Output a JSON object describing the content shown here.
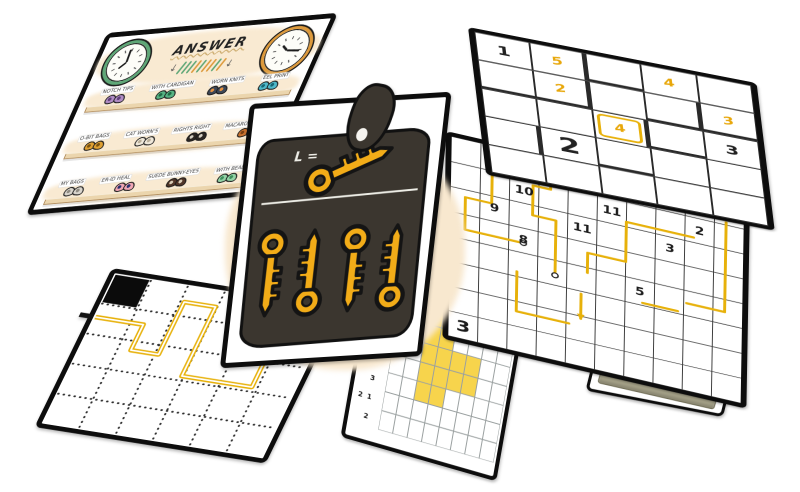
{
  "canvas": {
    "width": 800,
    "height": 492,
    "background": "#FFFFFF"
  },
  "colors": {
    "card_border": "#0D0D0D",
    "gold": "#F2AC18",
    "path_gold": "#E7B10A",
    "grid_line": "#3D3D3D",
    "nonogram_fill": "#F7D44C",
    "dark_blob": "#3B362F",
    "cream_wash": "#F8E8CF",
    "black_cell": "#0B0B0B"
  },
  "answer_card": {
    "title": "ANSWER",
    "clocks": [
      {
        "rim": "#5FA777",
        "hour_deg": 225,
        "minute_deg": 355
      },
      {
        "rim": "#DD9A3C",
        "hour_deg": 310,
        "minute_deg": 95
      }
    ],
    "arrow_glyph": "↓",
    "tick_colors": [
      "#5FA777",
      "#5FA777",
      "#5FA777",
      "#DD9A3C",
      "#5FA777",
      "#DD9A3C",
      "#DD9A3C",
      "#5FA777",
      "#DD9A3C"
    ],
    "shelves": [
      {
        "items": [
          {
            "label": "NOTCH TIPS",
            "color": "#B08CC4",
            "dark": "#5F3F78"
          },
          {
            "label": "WITH CARDIGAN",
            "color": "#56B383",
            "dark": "#1F6B45"
          },
          {
            "label": "WORN KNITS",
            "color": "#3C4757",
            "dark": "#E8923F"
          },
          {
            "label": "EEL PRINT",
            "color": "#4FB8C9",
            "dark": "#176876"
          }
        ]
      },
      {
        "items": [
          {
            "label": "O-BIT BAGS",
            "color": "#DFA032",
            "dark": "#7A5210"
          },
          {
            "label": "CAT WORN'S",
            "color": "#EFE8DA",
            "dark": "#B9AE98"
          },
          {
            "label": "RIGHTS RIGHT",
            "color": "#2B2622",
            "dark": "#D8D2C6"
          },
          {
            "label": "MACARONI PRINT",
            "color": "#C8712E",
            "dark": "#7A3F12"
          }
        ]
      },
      {
        "items": [
          {
            "label": "MY BAGS",
            "color": "#D9D5CD",
            "dark": "#8F8B82"
          },
          {
            "label": "ER-ID HEAL",
            "color": "#F0A6B4",
            "dark": "#27306E"
          },
          {
            "label": "SUEDE BUNNY-EYES",
            "color": "#503528",
            "dark": "#D9CDB8"
          },
          {
            "label": "WITH BEADS",
            "color": "#93D3A6",
            "dark": "#3E8F5D"
          }
        ]
      }
    ]
  },
  "keys_card": {
    "label": "L =",
    "key_count": 5
  },
  "sudoku_card": {
    "rows": 5,
    "cols": 5,
    "cells": [
      {
        "r": 0,
        "c": 0,
        "v": "1",
        "ink": "black"
      },
      {
        "r": 0,
        "c": 1,
        "v": "5",
        "ink": "yellow"
      },
      {
        "r": 1,
        "c": 1,
        "v": "2",
        "ink": "yellow"
      },
      {
        "r": 0,
        "c": 3,
        "v": "4",
        "ink": "yellow"
      },
      {
        "r": 1,
        "c": 4,
        "v": "3",
        "ink": "yellow"
      },
      {
        "r": 2,
        "c": 2,
        "v": "4",
        "ink": "yellow",
        "highlight": true
      },
      {
        "r": 2,
        "c": 4,
        "v": "3",
        "ink": "black"
      },
      {
        "r": 3,
        "c": 1,
        "v": "2",
        "ink": "black",
        "big": true
      }
    ],
    "thick_edges": [
      {
        "r": 0,
        "c": 1,
        "side": "right"
      },
      {
        "r": 1,
        "c": 1,
        "side": "right"
      },
      {
        "r": 1,
        "c": 0,
        "side": "bottom"
      },
      {
        "r": 1,
        "c": 1,
        "side": "bottom"
      },
      {
        "r": 0,
        "c": 2,
        "side": "bottom"
      },
      {
        "r": 1,
        "c": 3,
        "side": "right"
      },
      {
        "r": 1,
        "c": 3,
        "side": "bottom"
      },
      {
        "r": 1,
        "c": 4,
        "side": "bottom"
      },
      {
        "r": 2,
        "c": 2,
        "side": "right"
      },
      {
        "r": 2,
        "c": 3,
        "side": "bottom"
      },
      {
        "r": 3,
        "c": 0,
        "side": "right"
      },
      {
        "r": 3,
        "c": 2,
        "side": "bottom"
      }
    ]
  },
  "numberlink_card": {
    "cols": 10,
    "rows": 8,
    "numbers": [
      {
        "c": 3,
        "r": 0,
        "v": "10"
      },
      {
        "c": 2,
        "r": 1,
        "v": "10"
      },
      {
        "c": 5,
        "r": 1,
        "v": "11"
      },
      {
        "c": 8,
        "r": 1,
        "v": "2"
      },
      {
        "c": 1,
        "r": 2,
        "v": "9"
      },
      {
        "c": 4,
        "r": 2,
        "v": "11"
      },
      {
        "c": 7,
        "r": 2,
        "v": "3"
      },
      {
        "c": 2,
        "r": 3,
        "v": "8"
      },
      {
        "c": 6,
        "r": 4,
        "v": "5"
      },
      {
        "c": 0,
        "r": 7,
        "v": "3",
        "big": true
      }
    ],
    "paths": [
      [
        [
          1.4,
          0
        ],
        [
          1.4,
          2.3
        ],
        [
          0.5,
          2.3
        ],
        [
          0.5,
          3.6
        ],
        [
          2.5,
          3.6
        ]
      ],
      [
        [
          3.4,
          0
        ],
        [
          3.4,
          1.2
        ],
        [
          2.8,
          1.2
        ],
        [
          2.8,
          2.4
        ],
        [
          3.6,
          2.4
        ],
        [
          3.6,
          4.6
        ]
      ],
      [
        [
          2.3,
          4.8
        ],
        [
          2.3,
          6.4
        ],
        [
          4.1,
          6.4
        ]
      ],
      [
        [
          4.5,
          5.1
        ],
        [
          4.5,
          6.1
        ]
      ],
      [
        [
          8.3,
          1.8
        ],
        [
          6.0,
          1.8
        ],
        [
          6.0,
          3.4
        ],
        [
          4.7,
          3.4
        ],
        [
          4.7,
          4.2
        ]
      ],
      [
        [
          9.4,
          0.9
        ],
        [
          9.4,
          4.5
        ],
        [
          8.1,
          4.5
        ]
      ],
      [
        [
          6.6,
          4.9
        ],
        [
          7.8,
          4.9
        ]
      ]
    ],
    "dots": [
      [
        2.5,
        3.6
      ],
      [
        3.6,
        4.6
      ]
    ],
    "arrows": [
      {
        "x": 4.5,
        "y": 6.1,
        "dir": "down"
      }
    ]
  },
  "dotted_card": {
    "cols": 6,
    "rows": 5,
    "black_cells": [
      [
        0,
        0
      ],
      [
        4,
        1
      ]
    ],
    "path": [
      [
        0.05,
        1.45
      ],
      [
        1.35,
        1.45
      ],
      [
        1.35,
        2.3
      ],
      [
        2.1,
        2.3
      ],
      [
        2.1,
        0.55
      ],
      [
        2.95,
        0.55
      ],
      [
        2.95,
        2.85
      ],
      [
        4.85,
        2.85
      ],
      [
        4.85,
        1.15
      ]
    ],
    "entry_row": 1.45
  },
  "nonogram_card": {
    "cols": 8,
    "rows": 8,
    "row_clues": [
      "2",
      "1 4",
      "2",
      "1",
      "2 1",
      "3",
      "2 1",
      "2"
    ],
    "filled": [
      [
        2,
        1
      ],
      [
        3,
        1
      ],
      [
        2,
        2
      ],
      [
        3,
        2
      ],
      [
        2,
        3
      ],
      [
        3,
        3
      ],
      [
        4,
        3
      ],
      [
        5,
        3
      ],
      [
        2,
        4
      ],
      [
        3,
        4
      ],
      [
        4,
        4
      ],
      [
        5,
        4
      ],
      [
        2,
        5
      ],
      [
        3,
        5
      ]
    ]
  },
  "shield_card": {
    "plaque_text": "MASTER QUAIL'S MANTLE"
  }
}
